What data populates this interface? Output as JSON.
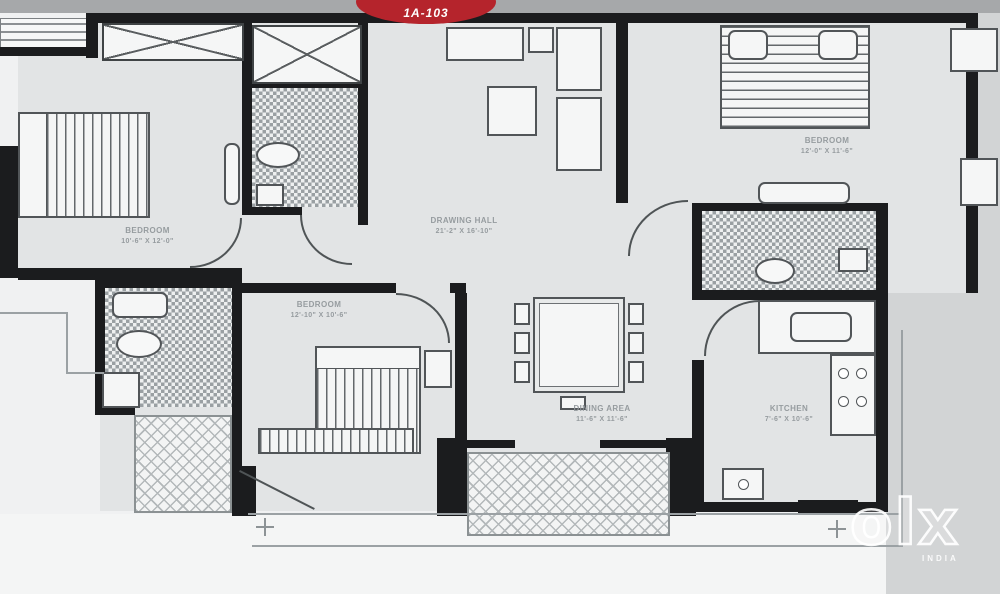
{
  "unit_badge": {
    "label": "1A-103",
    "color": "#b5242c"
  },
  "rooms": {
    "bedroom_top_left": {
      "name": "BEDROOM",
      "dims": "10'-6\" X 12'-0\""
    },
    "drawing_hall": {
      "name": "DRAWING HALL",
      "dims": "21'-2\" X 16'-10\""
    },
    "bedroom_top_right": {
      "name": "BEDROOM",
      "dims": "12'-0\" X 11'-6\""
    },
    "bedroom_bottom": {
      "name": "BEDROOM",
      "dims": "12'-10\" X 10'-6\""
    },
    "dining_area": {
      "name": "DINING AREA",
      "dims": "11'-6\" X 11'-6\""
    },
    "kitchen": {
      "name": "KITCHEN",
      "dims": "7'-6\" X 10'-6\""
    }
  },
  "watermark": {
    "brand": "olx",
    "region": "INDIA"
  },
  "colors": {
    "wall_black": "#1b1c1e",
    "floor_gray": "#e2e4e5",
    "badge_red": "#b5242c"
  }
}
